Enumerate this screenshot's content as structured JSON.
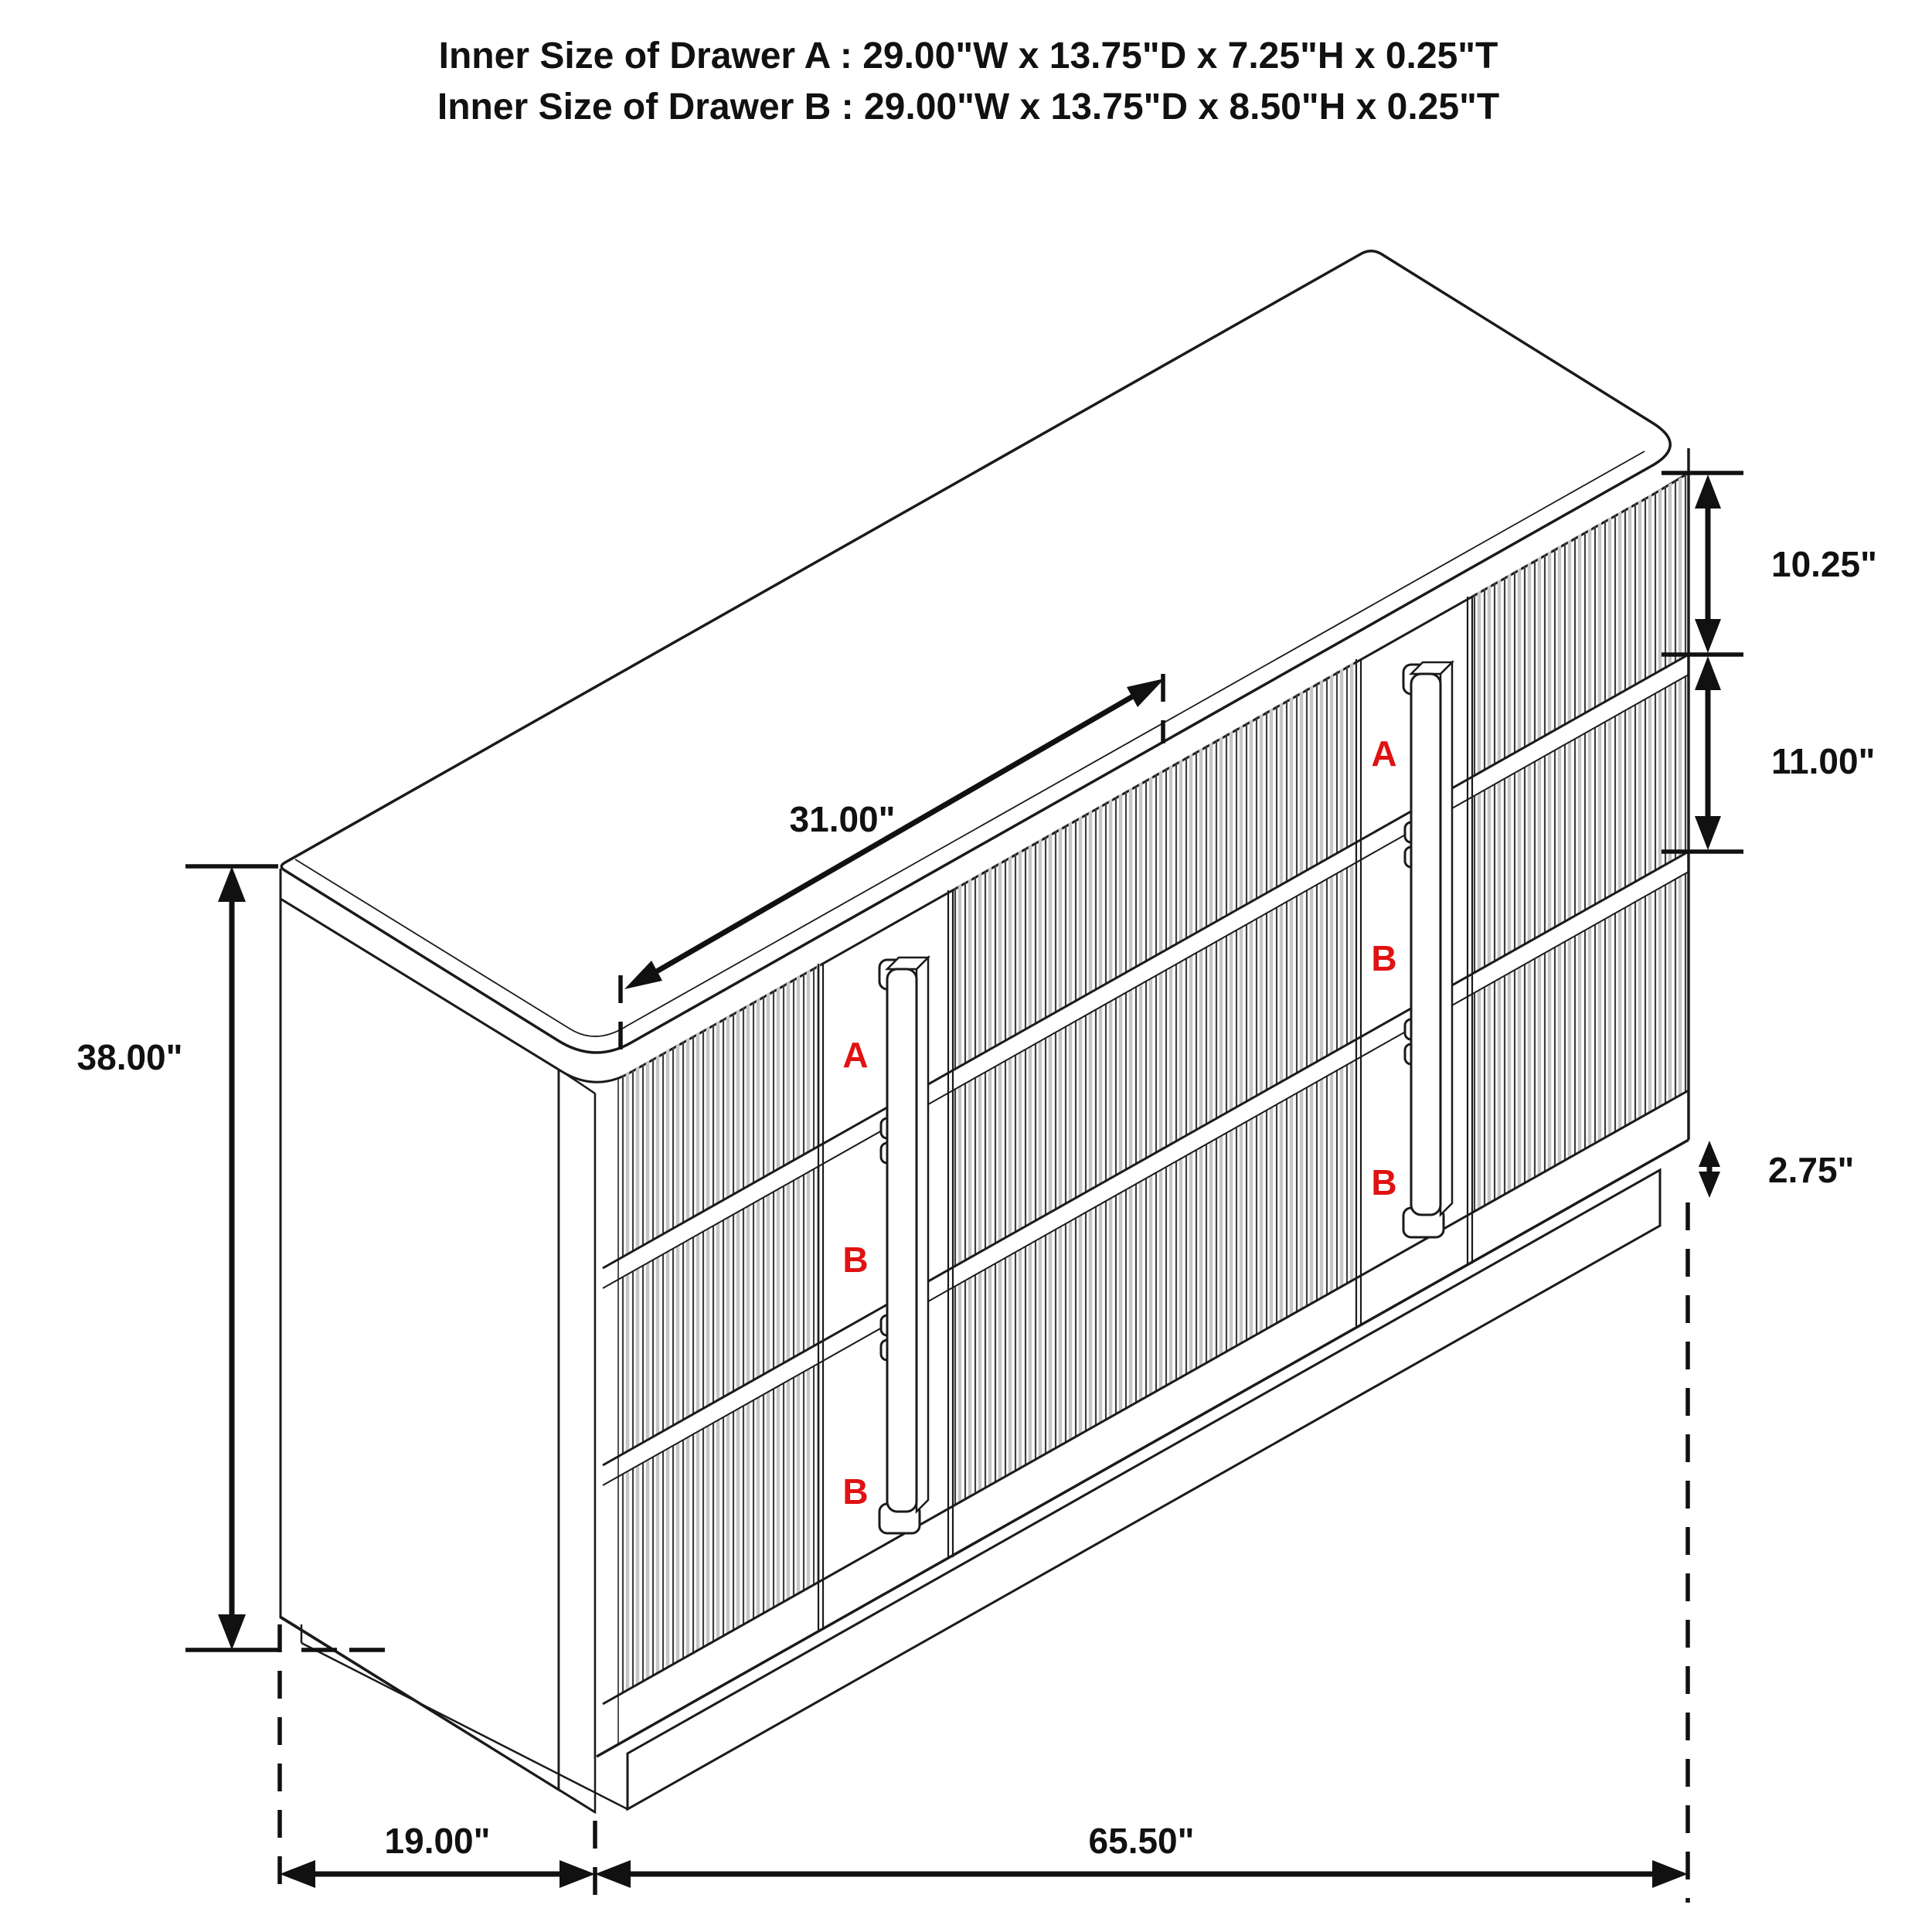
{
  "title": {
    "line1": "Inner Size of Drawer A : 29.00\"W x 13.75\"D x 7.25\"H x 0.25\"T",
    "line2": "Inner Size of Drawer B : 29.00\"W x 13.75\"D x 8.50\"H x 0.25\"T"
  },
  "dimensions": {
    "drawer_a_height": "10.25\"",
    "drawer_b_height": "11.00\"",
    "base_height": "2.75\"",
    "overall_height": "38.00\"",
    "depth": "19.00\"",
    "width": "65.50\"",
    "top_diagonal": "31.00\""
  },
  "drawer_labels": {
    "left": [
      "A",
      "B",
      "B"
    ],
    "right": [
      "A",
      "B",
      "B"
    ]
  },
  "colors": {
    "outline": "#1a1a1a",
    "flute": "#3f3f3f",
    "flute_shade": "#c6c6c6",
    "red": "#e01212"
  }
}
